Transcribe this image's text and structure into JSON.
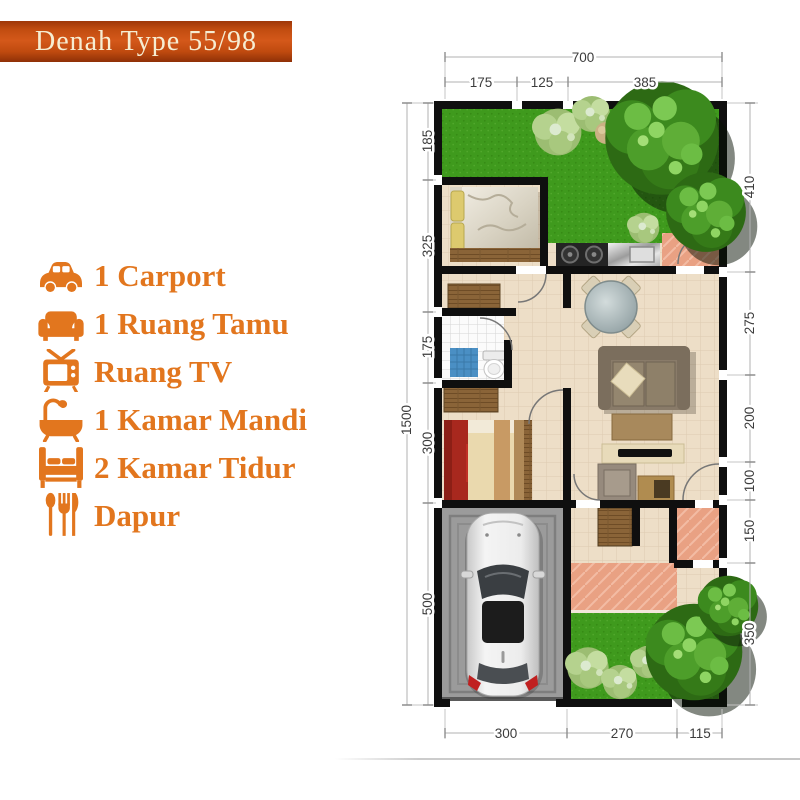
{
  "title": "Denah Type 55/98",
  "legend": {
    "items": [
      {
        "icon": "car-icon",
        "label": "1 Carport"
      },
      {
        "icon": "sofa-icon",
        "label": "1 Ruang Tamu"
      },
      {
        "icon": "tv-icon",
        "label": "Ruang TV"
      },
      {
        "icon": "bathtub-icon",
        "label": "1 Kamar Mandi"
      },
      {
        "icon": "bed-icon",
        "label": "2 Kamar Tidur"
      },
      {
        "icon": "cutlery-icon",
        "label": "Dapur"
      }
    ]
  },
  "floorplan": {
    "dim_top_total": "700",
    "dim_top": [
      "175",
      "125",
      "385"
    ],
    "dim_left_total": "1500",
    "dim_left": [
      "185",
      "325",
      "175",
      "300",
      "500"
    ],
    "dim_right": [
      "410",
      "275",
      "200",
      "100",
      "150",
      "350"
    ],
    "dim_bottom": [
      "300",
      "270",
      "115"
    ]
  },
  "colors": {
    "banner": "#c8500f",
    "banner_text": "#f6edd2",
    "accent_orange": "#e2761e",
    "wall": "#0f0f0f",
    "grass": "#3f9a1d",
    "floor": "#eddec7",
    "terrace": "#e9a183",
    "carport": "#9b9b9b",
    "dimension_text": "#3c3c3c"
  }
}
